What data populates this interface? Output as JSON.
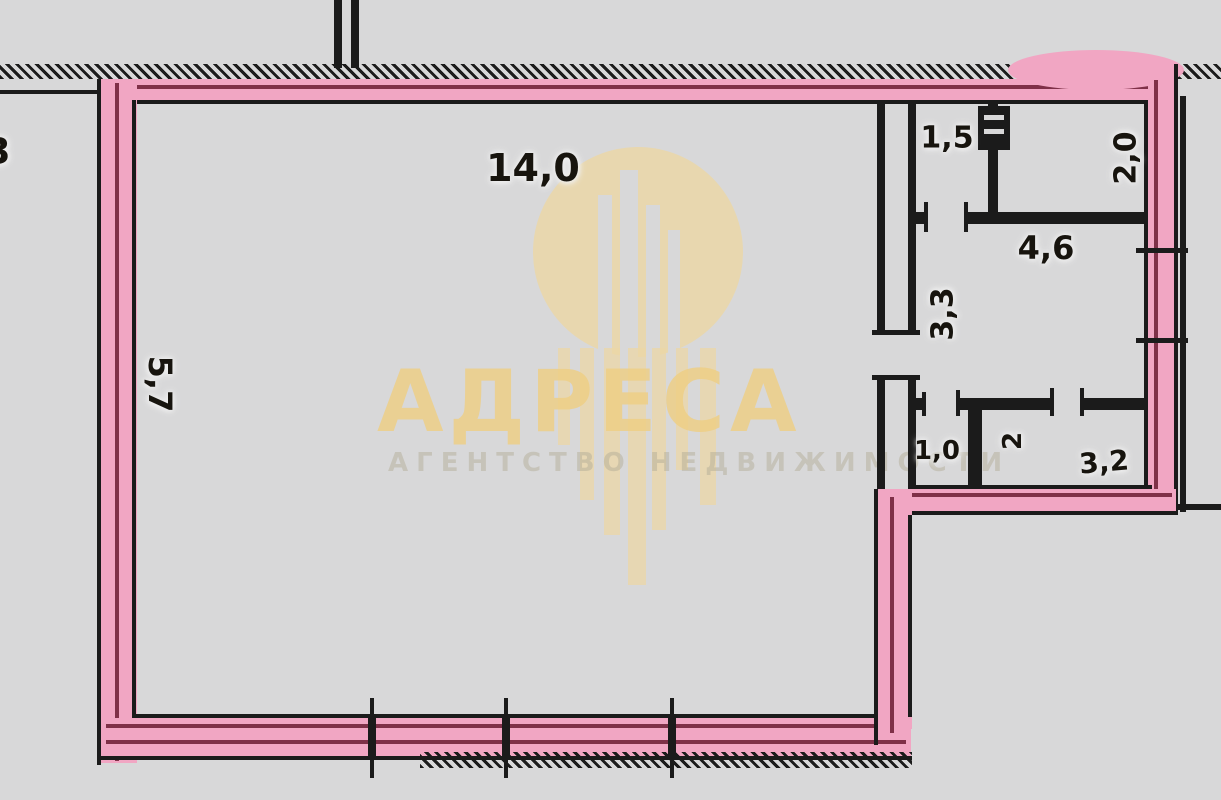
{
  "plan": {
    "background_color": "#d8d8d9",
    "wall_color": "#1b1b1b",
    "highlight_color": "#f1a6c3",
    "highlight_line_color": "#7f3048",
    "rooms": [
      {
        "name": "main-room",
        "label": "14,0"
      },
      {
        "name": "main-room-side-dim",
        "label": "5,7"
      },
      {
        "name": "top-small-room-left",
        "label": "1,5"
      },
      {
        "name": "top-small-room-right",
        "label": "2,0"
      },
      {
        "name": "kitchen",
        "label": "4,6"
      },
      {
        "name": "hallway",
        "label": "3,3"
      },
      {
        "name": "wc",
        "label": "1,0"
      },
      {
        "name": "bath-small",
        "label": "2"
      },
      {
        "name": "bathroom",
        "label": "3,2"
      },
      {
        "name": "edge-partial",
        "label": "3"
      }
    ]
  },
  "watermark": {
    "brand": "АДРЕСА",
    "tagline": "АГЕНТСТВО НЕДВИЖИМОСТИ",
    "logo": "building-circle-icon",
    "color": "#ecd7a6"
  }
}
